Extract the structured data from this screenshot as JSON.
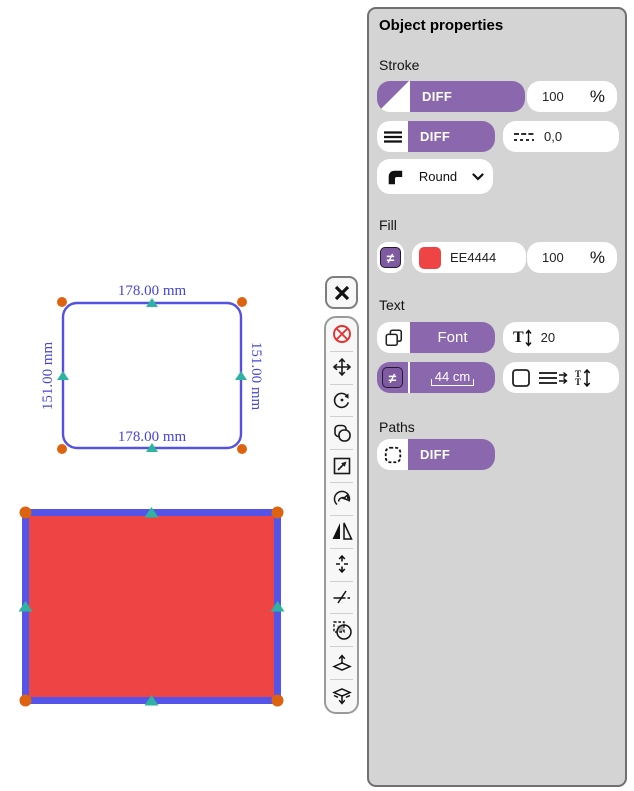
{
  "canvas": {
    "selected_shape": {
      "width_label_top": "178.00 mm",
      "width_label_bottom": "178.00 mm",
      "height_label_left": "151.00 mm",
      "height_label_right": "151.00 mm"
    },
    "red_shape": {
      "fill_hex": "#EE4444",
      "stroke_hex": "#5454E8"
    }
  },
  "floating_toolbar": {
    "tools": [
      {
        "name": "cancel"
      },
      {
        "name": "move"
      },
      {
        "name": "rotate"
      },
      {
        "name": "clone"
      },
      {
        "name": "scale"
      },
      {
        "name": "distort"
      },
      {
        "name": "mirror-horizontal"
      },
      {
        "name": "flip-vertical"
      },
      {
        "name": "cut"
      },
      {
        "name": "mask"
      },
      {
        "name": "raise"
      },
      {
        "name": "lower"
      }
    ]
  },
  "properties_panel": {
    "title": "Object properties",
    "stroke": {
      "label": "Stroke",
      "color_button_label": "DIFF",
      "opacity_value": "100",
      "opacity_unit": "%",
      "width_button_label": "DIFF",
      "dash_value": "0,0",
      "join_value": "Round"
    },
    "fill": {
      "label": "Fill",
      "color_hex": "EE4444",
      "opacity_value": "100",
      "opacity_unit": "%"
    },
    "text": {
      "label": "Text",
      "font_button_label": "Font",
      "font_size_value": "20",
      "offset_button_label": "44 cm"
    },
    "paths": {
      "label": "Paths",
      "diff_button_label": "DIFF"
    }
  },
  "colors": {
    "accent_purple": "#8B68AD",
    "panel_background": "#D4D4D4",
    "selection_blue": "#5353E0",
    "handle_orange": "#DD6311",
    "node_teal": "#2EB3A3",
    "cancel_red": "#E23333",
    "fill_red": "#EE4444"
  }
}
